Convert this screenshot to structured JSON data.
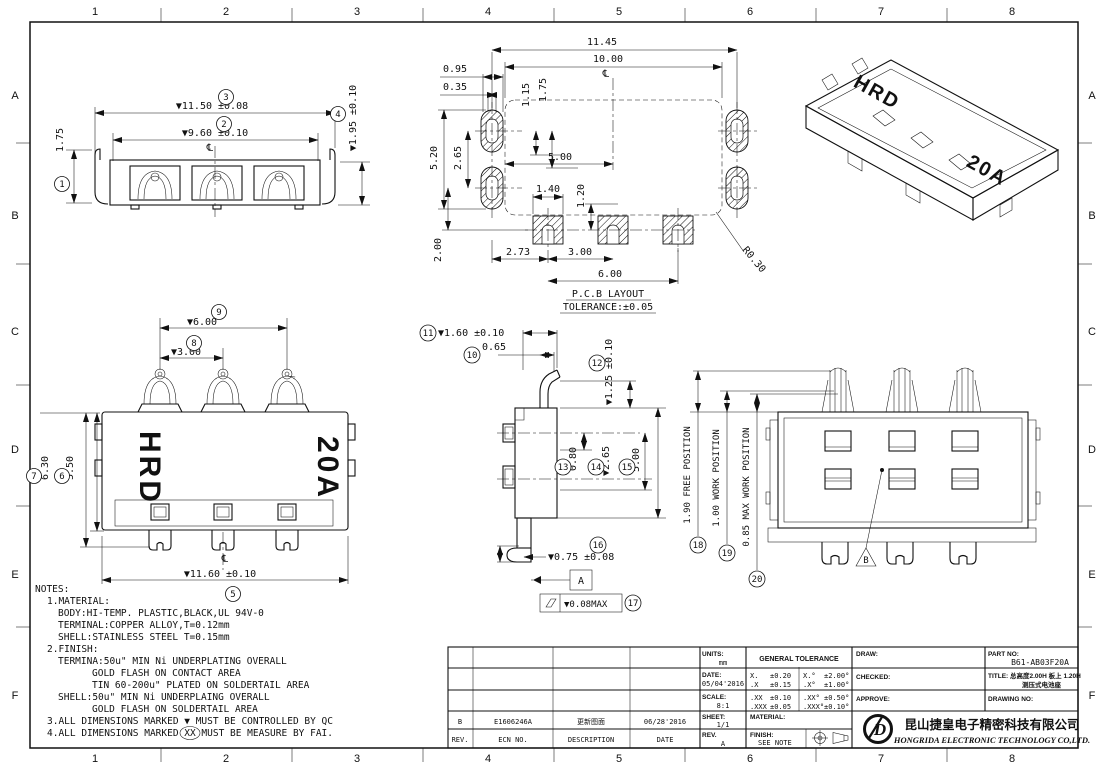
{
  "sheet": {
    "cols": [
      "1",
      "2",
      "3",
      "4",
      "5",
      "6",
      "7",
      "8"
    ],
    "rows": [
      "A",
      "B",
      "C",
      "D",
      "E",
      "F"
    ]
  },
  "balloons": [
    "1",
    "2",
    "3",
    "4",
    "5",
    "6",
    "7",
    "8",
    "9",
    "10",
    "11",
    "12",
    "13",
    "14",
    "15",
    "16",
    "17",
    "18",
    "19",
    "20"
  ],
  "front_view": {
    "dim_overall": "▼11.50 ±0.08",
    "dim_inner": "▼9.60 ±0.10",
    "dim_height": "1.75",
    "dim_shell_height": "▼1.95 ±0.10",
    "centerline": "℄"
  },
  "pcb_view": {
    "dim_total_width": "11.45",
    "dim_pad_span": "10.00",
    "d_0_95": "0.95",
    "d_0_35": "0.35",
    "d_1_15": "1.15",
    "d_1_75": "1.75",
    "d_5_20": "5.20",
    "d_2_65": "2.65",
    "d_5_00": "5.00",
    "d_1_40": "1.40",
    "d_1_20": "1.20",
    "d_2_00": "2.00",
    "d_2_73": "2.73",
    "d_3_00": "3.00",
    "d_6_00": "6.00",
    "d_radius": "R0.30",
    "caption_top": "P.C.B  LAYOUT",
    "caption_bottom": "TOLERANCE:±0.05",
    "centerline": "℄"
  },
  "top_view": {
    "d_6_00": "▼6.00",
    "d_3_00": "▼3.00",
    "d_6_30": "6.30",
    "d_5_50": "5.50",
    "d_11_60": "▼11.60 ±0.10",
    "brand": "HRD",
    "rating": "20A",
    "centerline": "℄"
  },
  "side_view": {
    "d_1_60": "▼1.60 ±0.10",
    "d_0_65": "0.65",
    "d_1_25": "▼1.25 ±0.10",
    "d_0_80": "0.80",
    "d_2_65": "▼2.65",
    "d_5_00": "5.00",
    "d_0_75": "▼0.75 ±0.08",
    "datum": "A",
    "flatness": "▼0.08MAX"
  },
  "back_view": {
    "free_position": "1.90 FREE POSITION",
    "work_position": "1.00 WORK POSITION",
    "max_work_position": "0.85 MAX WORK POSITION",
    "datum": "B"
  },
  "iso_view": {
    "brand": "HRD",
    "rating": "20A"
  },
  "notes": {
    "title": "NOTES:",
    "n1": "1.MATERIAL:",
    "n1a": "BODY:HI-TEMP. PLASTIC,BLACK,UL 94V-0",
    "n1b": "TERMINAL:COPPER ALLOY,T=0.12mm",
    "n1c": "SHELL:STAINLESS STEEL T=0.15mm",
    "n2": "2.FINISH:",
    "n2a": "TERMINA:50u\" MIN Ni UNDERPLATING OVERALL",
    "n2b": "GOLD FLASH ON CONTACT AREA",
    "n2c": "TIN 60-200u\" PLATED ON SOLDERTAIL AREA",
    "n2d": "SHELL:50u\" MIN Ni UNDERPLAING OVERALL",
    "n2e": "GOLD FLASH ON SOLDERTAIL AREA",
    "n3": "3.ALL DIMENSIONS MARKED ▼ MUST BE CONTROLLED BY QC",
    "n4": "4.ALL DIMENSIONS MARKED XX MUST BE MEASURE BY FAI."
  },
  "title_block": {
    "rev_value": "B",
    "ecn_value": "E1606246A",
    "desc_value": "更新图面",
    "date_value2": "06/28'2016",
    "rev_header": "REV.",
    "ecn_header": "ECN NO.",
    "desc_header": "DESCRIPTION",
    "date_header": "DATE",
    "units_label": "UNITS:",
    "units": "mm",
    "date_label": "DATE:",
    "date": "05/04'2016",
    "scale_label": "SCALE:",
    "scale": "8:1",
    "sheet_label": "SHEET:",
    "sheet": "1/1",
    "rev_label": "REV.",
    "rev": "A",
    "tol_header": "GENERAL TOLERANCE",
    "tol": [
      [
        "X.",
        "±0.20"
      ],
      [
        ".X",
        "±0.15"
      ],
      [
        ".XX",
        "±0.10"
      ],
      [
        ".XXX",
        "±0.05"
      ]
    ],
    "tol_deg": [
      [
        "X.°",
        "±2.00°"
      ],
      [
        ".X°",
        "±1.00°"
      ],
      [
        ".XX°",
        "±0.50°"
      ],
      [
        ".XXX°",
        "±0.10°"
      ]
    ],
    "material_label": "MATERIAL:",
    "finish_label": "FINISH:",
    "finish": "SEE NOTE",
    "draw_label": "DRAW:",
    "checked_label": "CHECKED:",
    "approve_label": "APPROVE:",
    "part_label": "PART NO:",
    "part_no": "B61-AB03F20A",
    "title_label": "TITLE:",
    "title_line1": "总高度2.00H 板上 1.20H",
    "title_line2": "测压式电池座",
    "drawing_label": "DRAWING NO:",
    "company_cn": "昆山捷皇电子精密科技有限公司",
    "company_en": "HONGRIDA ELECTRONIC TECHNOLOGY CO,LTD.",
    "logo": "D"
  }
}
